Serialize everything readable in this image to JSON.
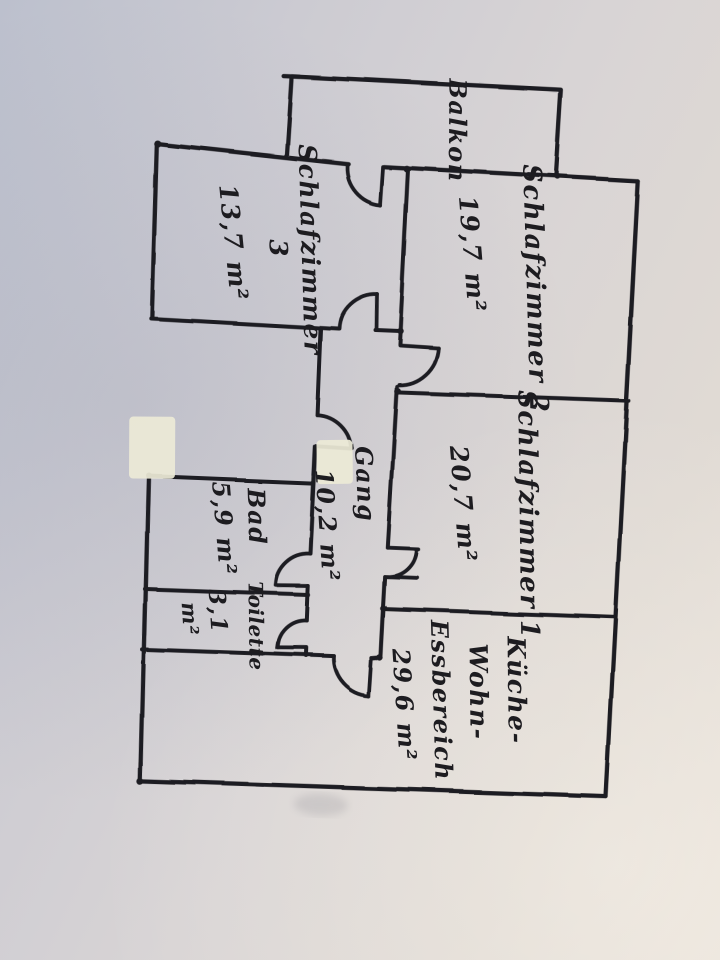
{
  "page": {
    "description": "Handwritten apartment floor plan sketch, photographed rotated 90 degrees"
  },
  "colors": {
    "ink": "#1d1c20",
    "paper_light": "#e9e2da",
    "paper_shadow": "#bcc0cd",
    "whiteout_patch": "#ece9d6"
  },
  "rooms": {
    "balkon": {
      "name": "Balkon"
    },
    "schlafzimmer2": {
      "name": "Schlafzimmer 2",
      "area": "19,7 m²"
    },
    "schlafzimmer3": {
      "name": "Schlafzimmer",
      "number": "3",
      "area": "13,7 m²"
    },
    "schlafzimmer1": {
      "name": "Schlafzimmer 1",
      "area": "20,7 m²"
    },
    "gang": {
      "name": "Gang",
      "area": "10,2 m²"
    },
    "bad": {
      "name": "Bad",
      "area": "5,9 m²"
    },
    "toilette": {
      "name": "Toilette",
      "area_value": "3,1",
      "area_unit": "m²"
    },
    "kueche_wohn_essbereich": {
      "name_line1": "Küche-",
      "name_line2": "Wohn-",
      "name_line3": "Essbereich",
      "area": "29,6 m²"
    }
  }
}
